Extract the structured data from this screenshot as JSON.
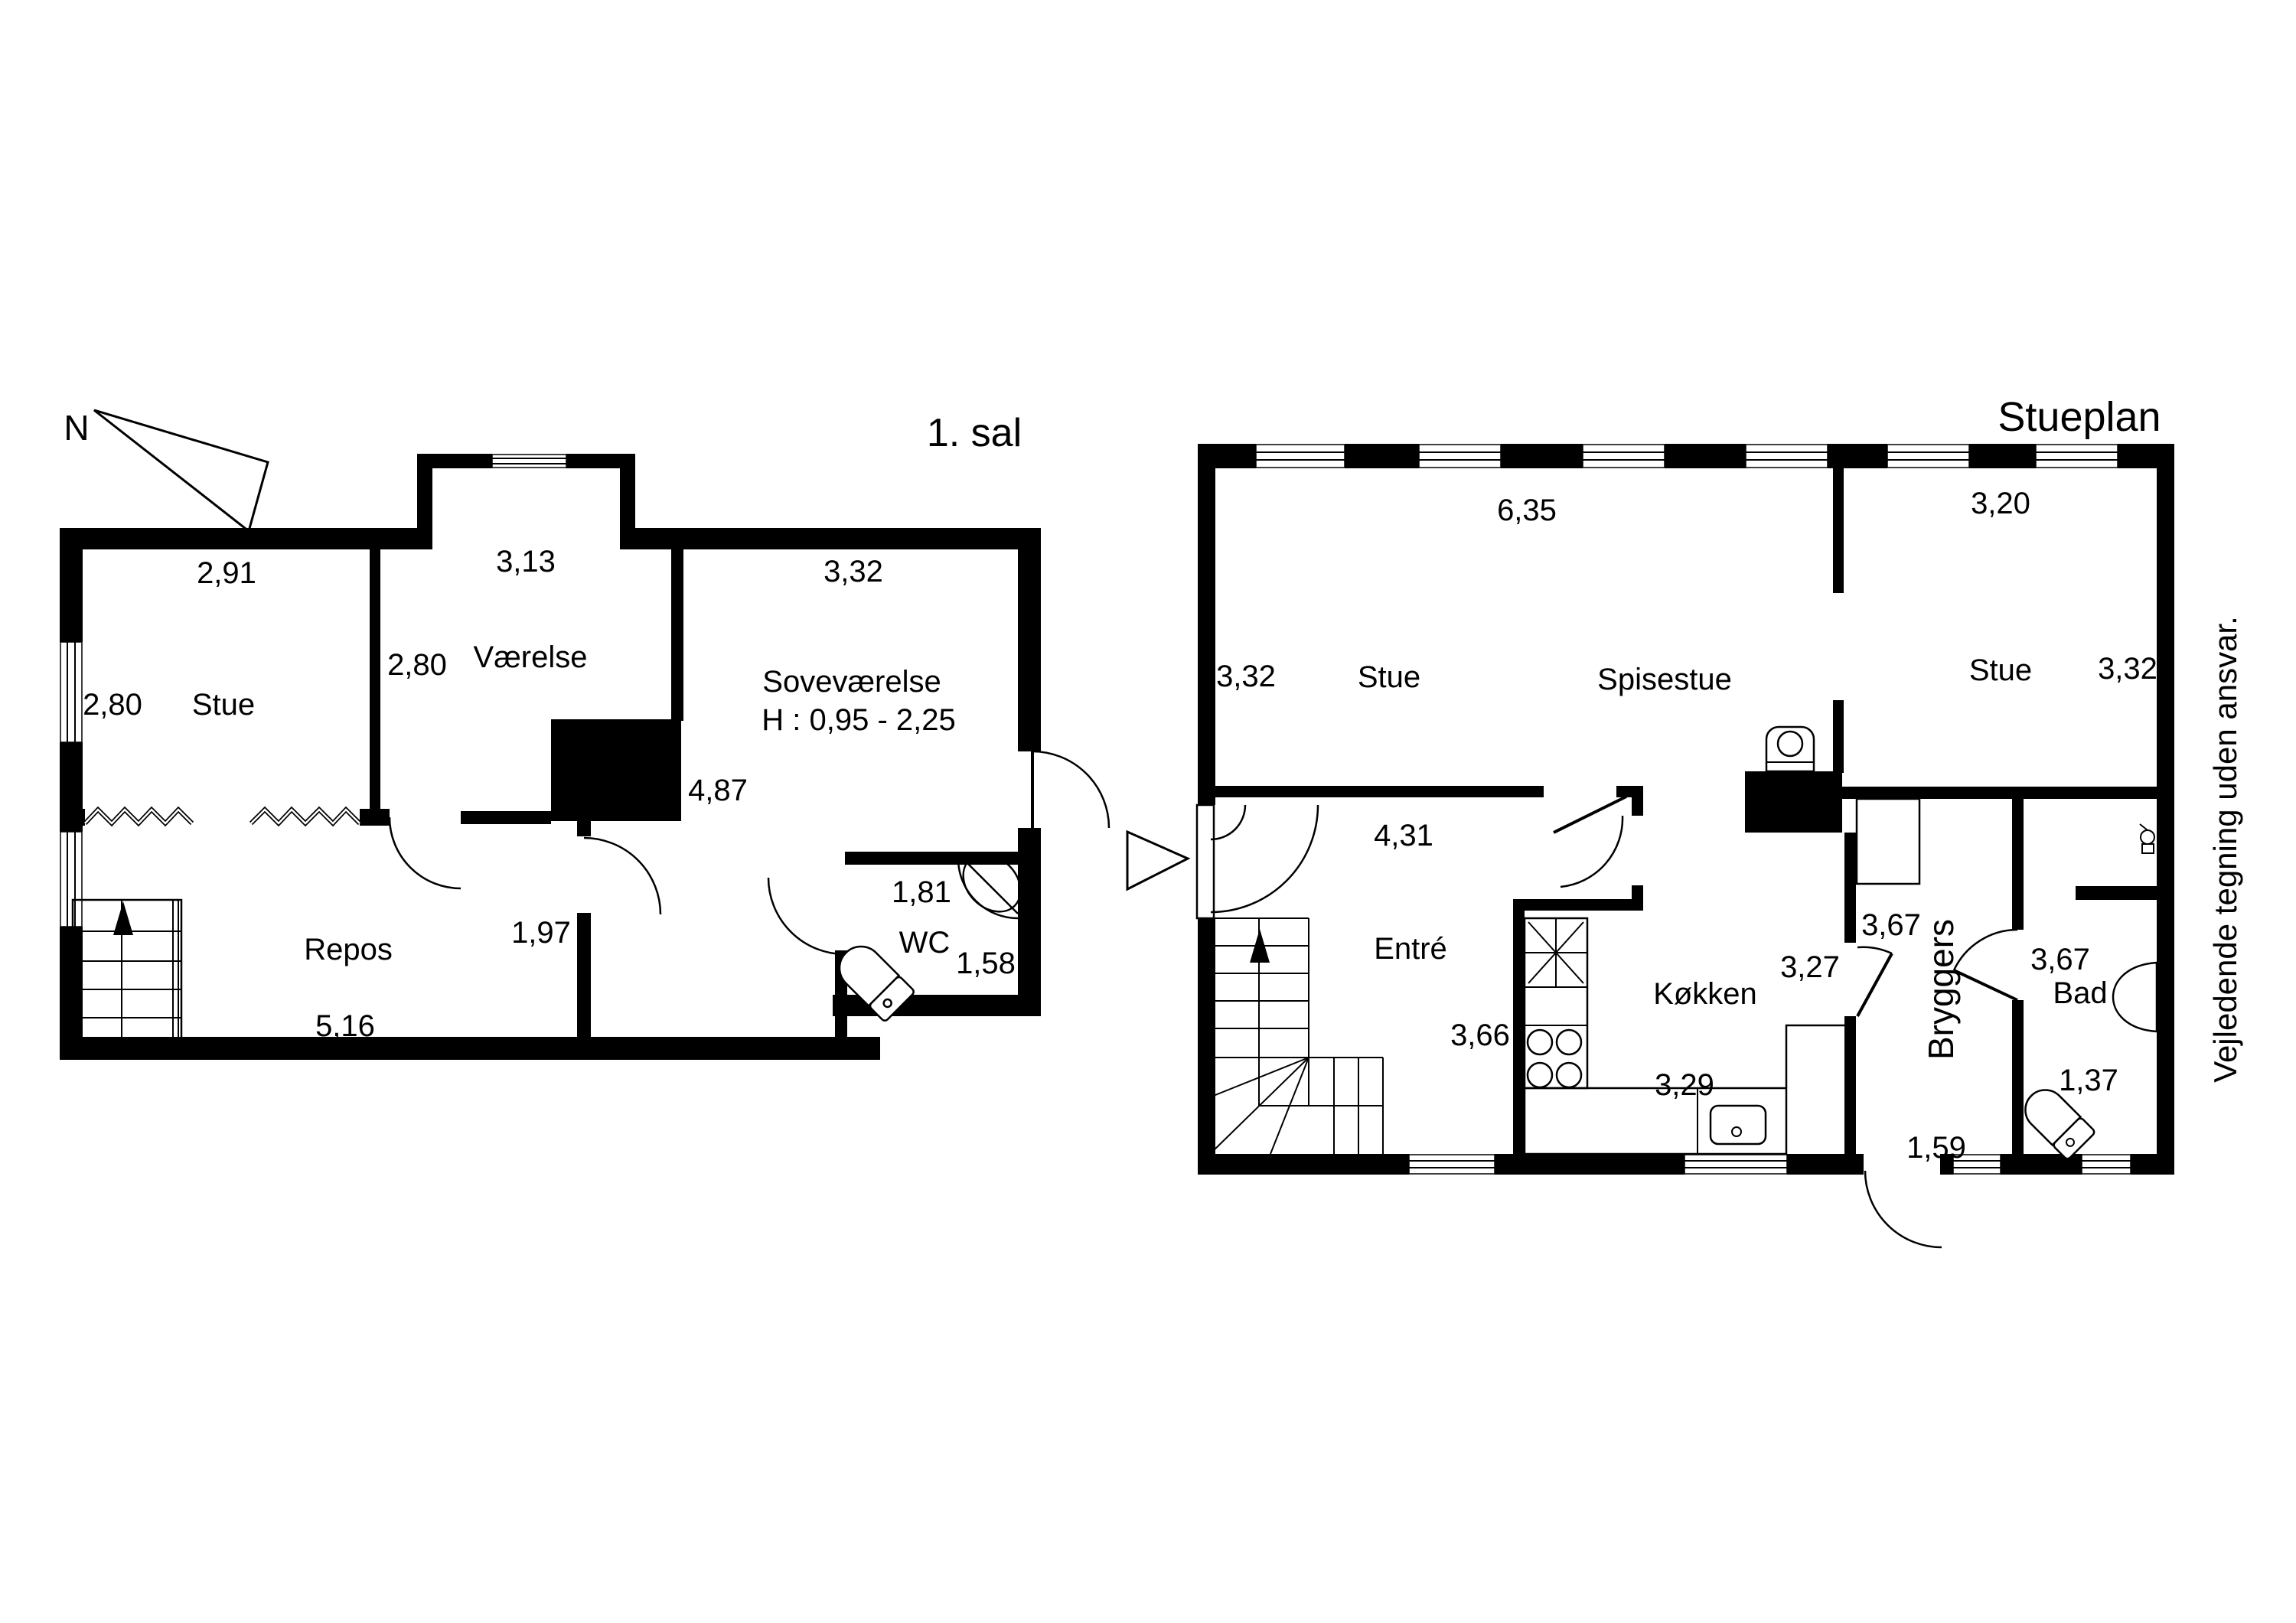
{
  "page": {
    "background": "#ffffff",
    "ink": "#000000"
  },
  "compass": {
    "label": "N"
  },
  "pointer": {
    "shape": "triangle-right"
  },
  "disclaimer": "Vejledende tegning uden ansvar.",
  "floor1": {
    "title": "1. sal",
    "labels": {
      "stue": "Stue",
      "vaerelse": "Værelse",
      "sovevaerelse": "Soveværelse",
      "sove_height": "H : 0,95 - 2,25",
      "repos": "Repos",
      "wc": "WC"
    },
    "dims": {
      "stue_w": "2,91",
      "stue_h": "2,80",
      "vaerelse_w": "3,13",
      "vaerelse_h": "2,80",
      "sove_w": "3,32",
      "sove_h": "4,87",
      "nook_w": "1,97",
      "repos_w": "5,16",
      "wc_w": "1,81",
      "wc_h": "1,58"
    }
  },
  "floor0": {
    "title": "Stueplan",
    "labels": {
      "stue_left": "Stue",
      "spisestue": "Spisestue",
      "stue_right": "Stue",
      "entre": "Entré",
      "koekken": "Køkken",
      "bryggers": "Bryggers",
      "bad": "Bad"
    },
    "dims": {
      "stue_w": "6,35",
      "stue_right_w": "3,20",
      "stue_left_h": "3,32",
      "stue_right_h": "3,32",
      "entre_w": "4,31",
      "entre_h": "3,66",
      "koekken_w": "3,27",
      "koekken_b": "3,29",
      "bryggers_h": "3,67",
      "bryggers_w": "1,59",
      "bad_h": "3,67",
      "bad_w": "1,37"
    }
  }
}
